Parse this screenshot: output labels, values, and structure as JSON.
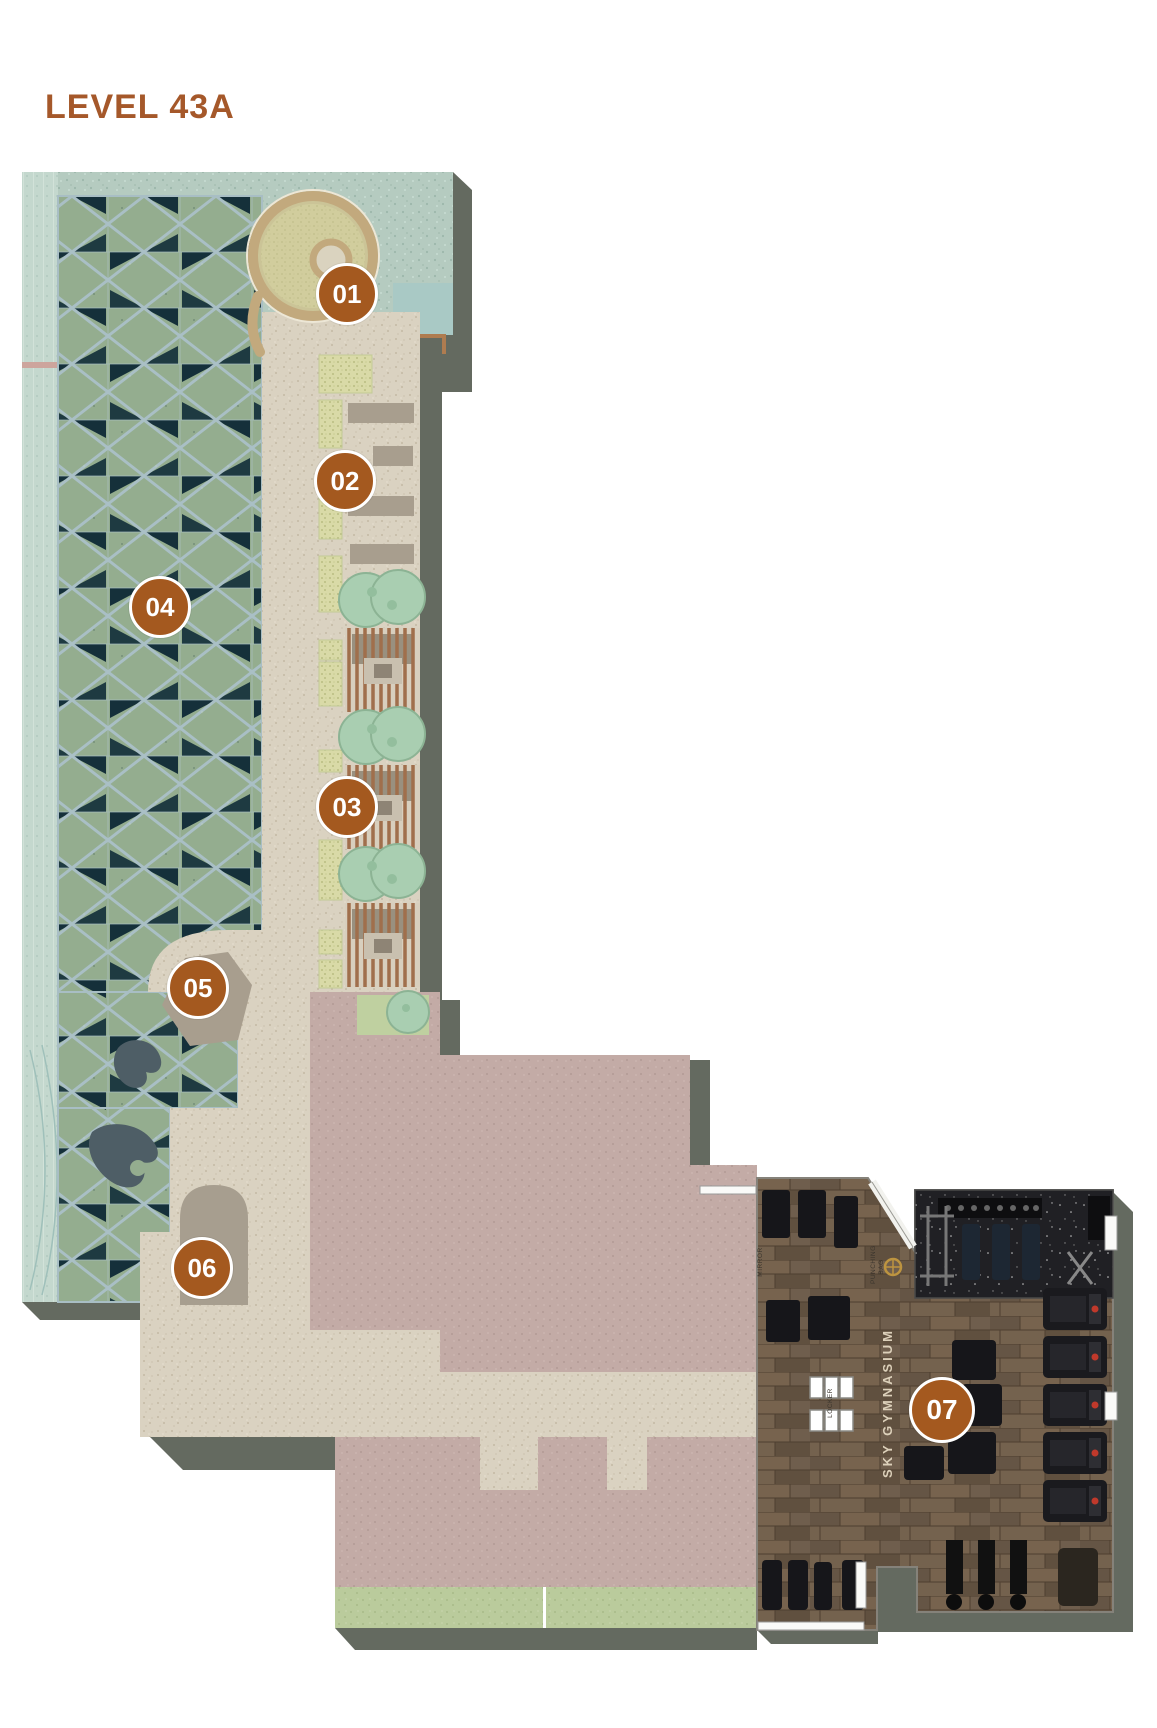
{
  "title": "LEVEL 43A",
  "markers": [
    {
      "label": "01"
    },
    {
      "label": "02"
    },
    {
      "label": "03"
    },
    {
      "label": "04"
    },
    {
      "label": "05"
    },
    {
      "label": "06"
    },
    {
      "label": "07"
    }
  ],
  "labels": {
    "gym_name": "SKY GYMNASIUM",
    "mirror": "MIRROR",
    "punching_bag": "PUNCHING BAG",
    "locker": "LOCKER"
  },
  "colors": {
    "accent_marker": "#A4591F",
    "title": "#A5582A",
    "lattice_dark": "#1E3A41",
    "terrace_teal": "#B5CBC0",
    "walkway_beige": "#DAD2C1",
    "building_pink": "#C3ABA6",
    "gym_wood": "#6F5E4D",
    "rubber_mat": "#202024",
    "lawn_green": "#BACB9C"
  }
}
